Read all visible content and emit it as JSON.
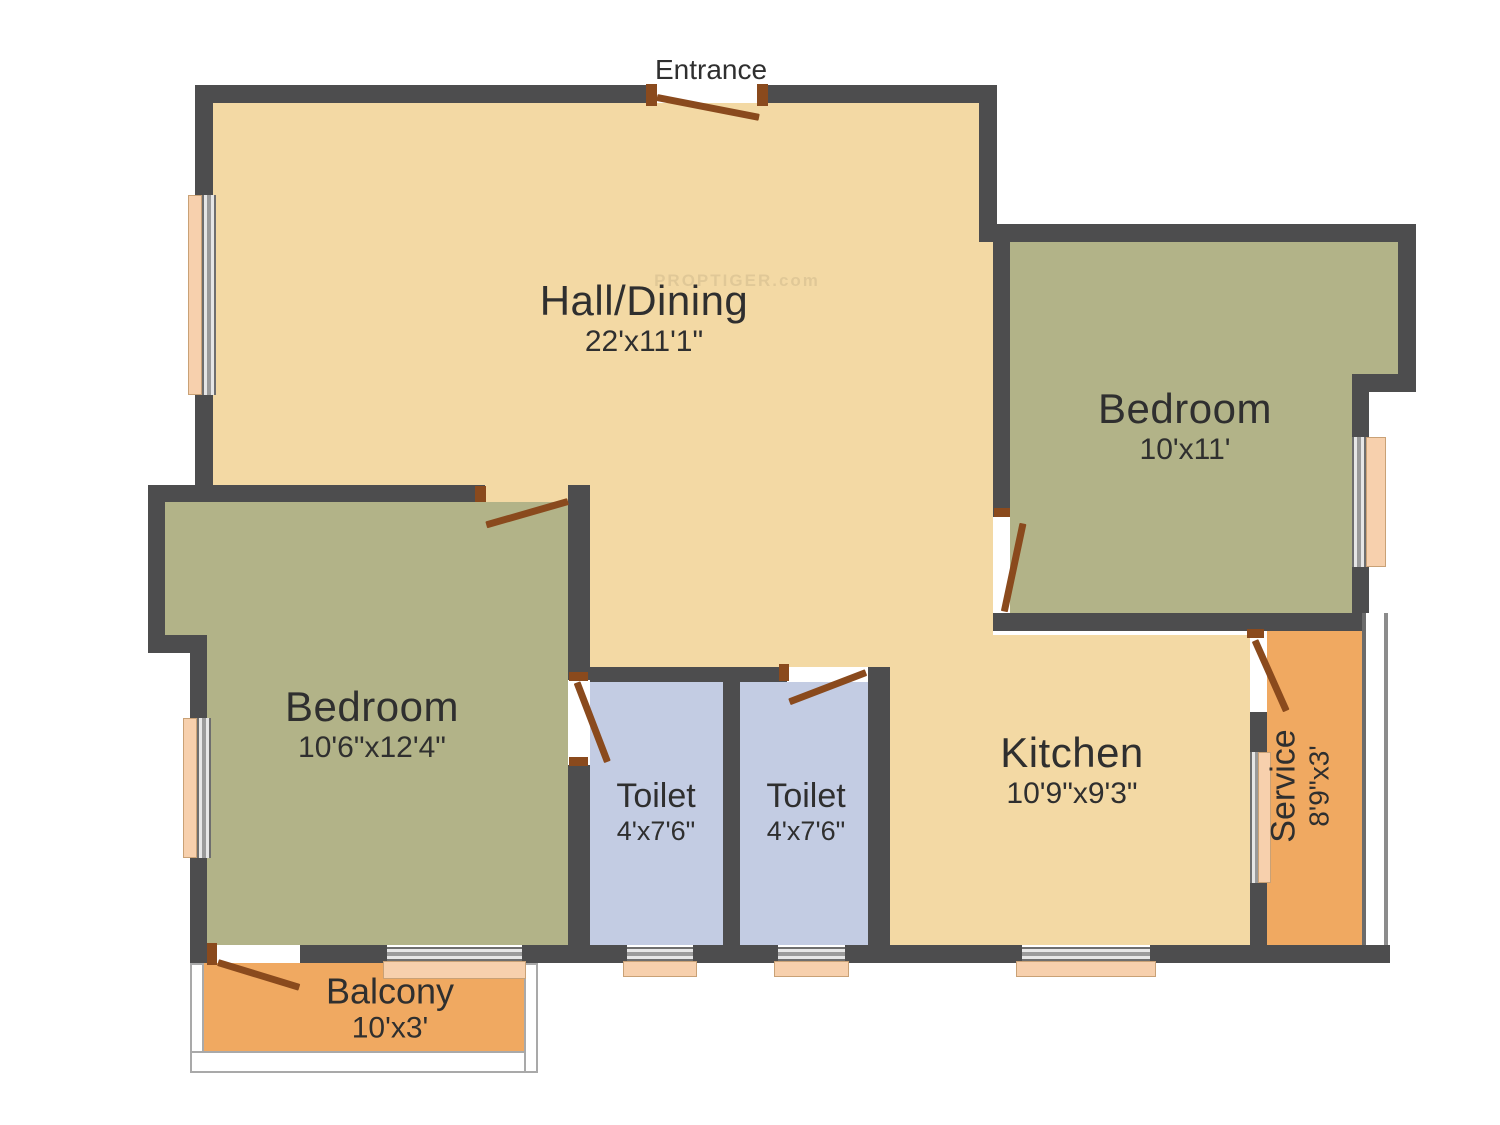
{
  "entrance_label": "Entrance",
  "watermark": "PROPTIGER.com",
  "rooms": {
    "hall": {
      "name": "Hall/Dining",
      "dims": "22'x11'1\""
    },
    "bedroom_right": {
      "name": "Bedroom",
      "dims": "10'x11'"
    },
    "bedroom_left": {
      "name": "Bedroom",
      "dims": "10'6\"x12'4\""
    },
    "toilet_left": {
      "name": "Toilet",
      "dims": "4'x7'6\""
    },
    "toilet_right": {
      "name": "Toilet",
      "dims": "4'x7'6\""
    },
    "kitchen": {
      "name": "Kitchen",
      "dims": "10'9\"x9'3\""
    },
    "service": {
      "name": "Service",
      "dims": "8'9\"x3'"
    },
    "balcony": {
      "name": "Balcony",
      "dims": "10'x3'"
    }
  },
  "colors": {
    "wall": "#4d4d4e",
    "hall_floor": "#f3d9a4",
    "bedroom_floor": "#b2b388",
    "toilet_floor": "#c3cce3",
    "service_floor": "#f0a961",
    "window": "#f7d0ad",
    "door": "#8a4a1d",
    "text": "#2f2f2f"
  }
}
